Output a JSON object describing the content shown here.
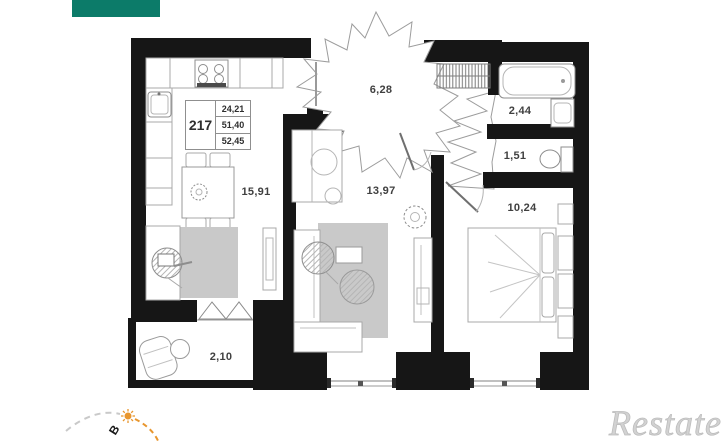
{
  "header": {
    "swatch_color": "#0c7b69"
  },
  "floorplan": {
    "unit_number": "217",
    "info_table": {
      "rows": [
        "24,21",
        "51,40",
        "52,45"
      ]
    },
    "rooms": [
      {
        "id": "hallway",
        "area": "6,28"
      },
      {
        "id": "bathroom",
        "area": "2,44"
      },
      {
        "id": "wc",
        "area": "1,51"
      },
      {
        "id": "bedroom",
        "area": "10,24"
      },
      {
        "id": "living-room",
        "area": "13,97"
      },
      {
        "id": "kitchen-living",
        "area": "15,91"
      },
      {
        "id": "balcony",
        "area": "2,10"
      }
    ],
    "compass": {
      "direction_label": "В",
      "sun_color": "#e8962e"
    },
    "watermark": "Restate",
    "wall_color": "#161616",
    "furniture_stroke": "#a8a8a8",
    "rug_color": "#c9c9c9"
  }
}
